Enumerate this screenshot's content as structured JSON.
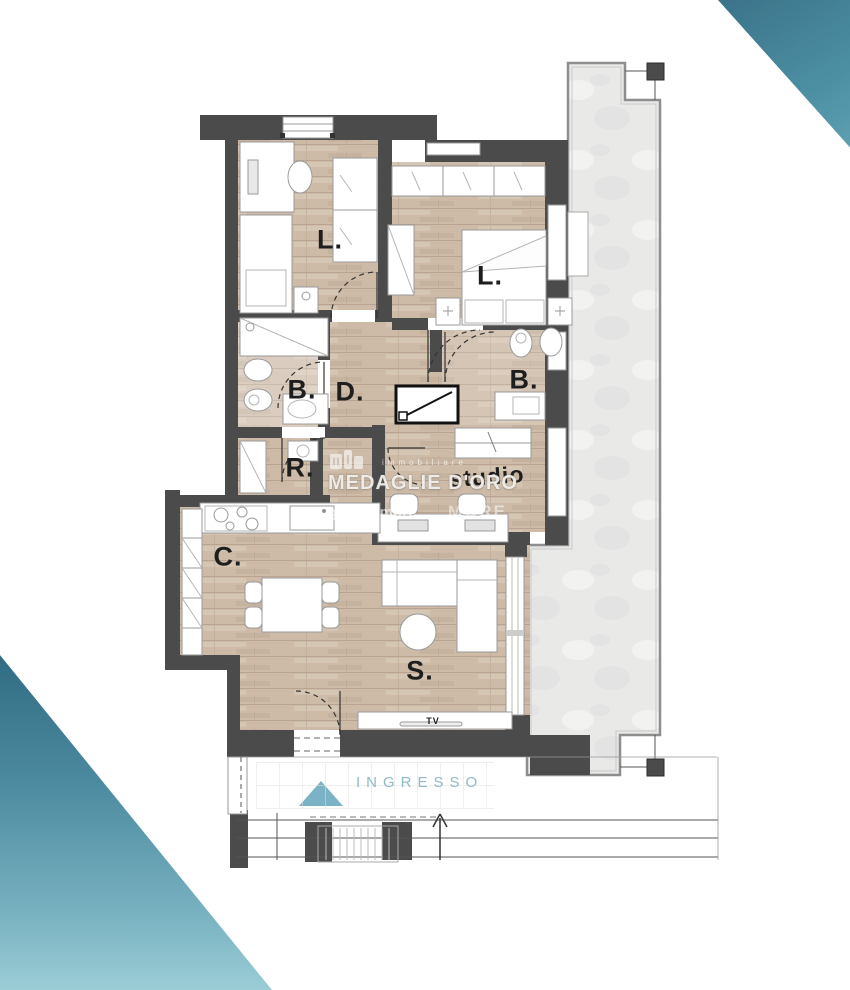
{
  "page": {
    "type": "apartment floor plan render",
    "background": "#ffffff"
  },
  "colors": {
    "wall": "#4b4b4c",
    "wood_floor": "#cdbba8",
    "terrace": "#e9e9e8",
    "accent_teal_dark": "#3a7187",
    "accent_teal_light": "#9bcdd6",
    "ingresso_text": "#8fb9ca",
    "ingresso_triangle": "#7cb2c6",
    "room_label": "#1e1e1e"
  },
  "rooms": [
    {
      "id": "bedroom-1",
      "label": "L."
    },
    {
      "id": "bedroom-2",
      "label": "L."
    },
    {
      "id": "bathroom-1",
      "label": "B."
    },
    {
      "id": "hallway",
      "label": "D."
    },
    {
      "id": "bathroom-2",
      "label": "B."
    },
    {
      "id": "storage",
      "label": "R."
    },
    {
      "id": "study",
      "label": "studio"
    },
    {
      "id": "kitchen",
      "label": "C."
    },
    {
      "id": "living-room",
      "label": "S."
    }
  ],
  "annotations": {
    "tv": "TV",
    "entrance": "INGRESSO"
  },
  "watermark": {
    "top_line": "immobiliare",
    "title": "MEDAGLIE D'ORO",
    "bottom_left": "gruppomore",
    "bottom_right": "MORE"
  }
}
